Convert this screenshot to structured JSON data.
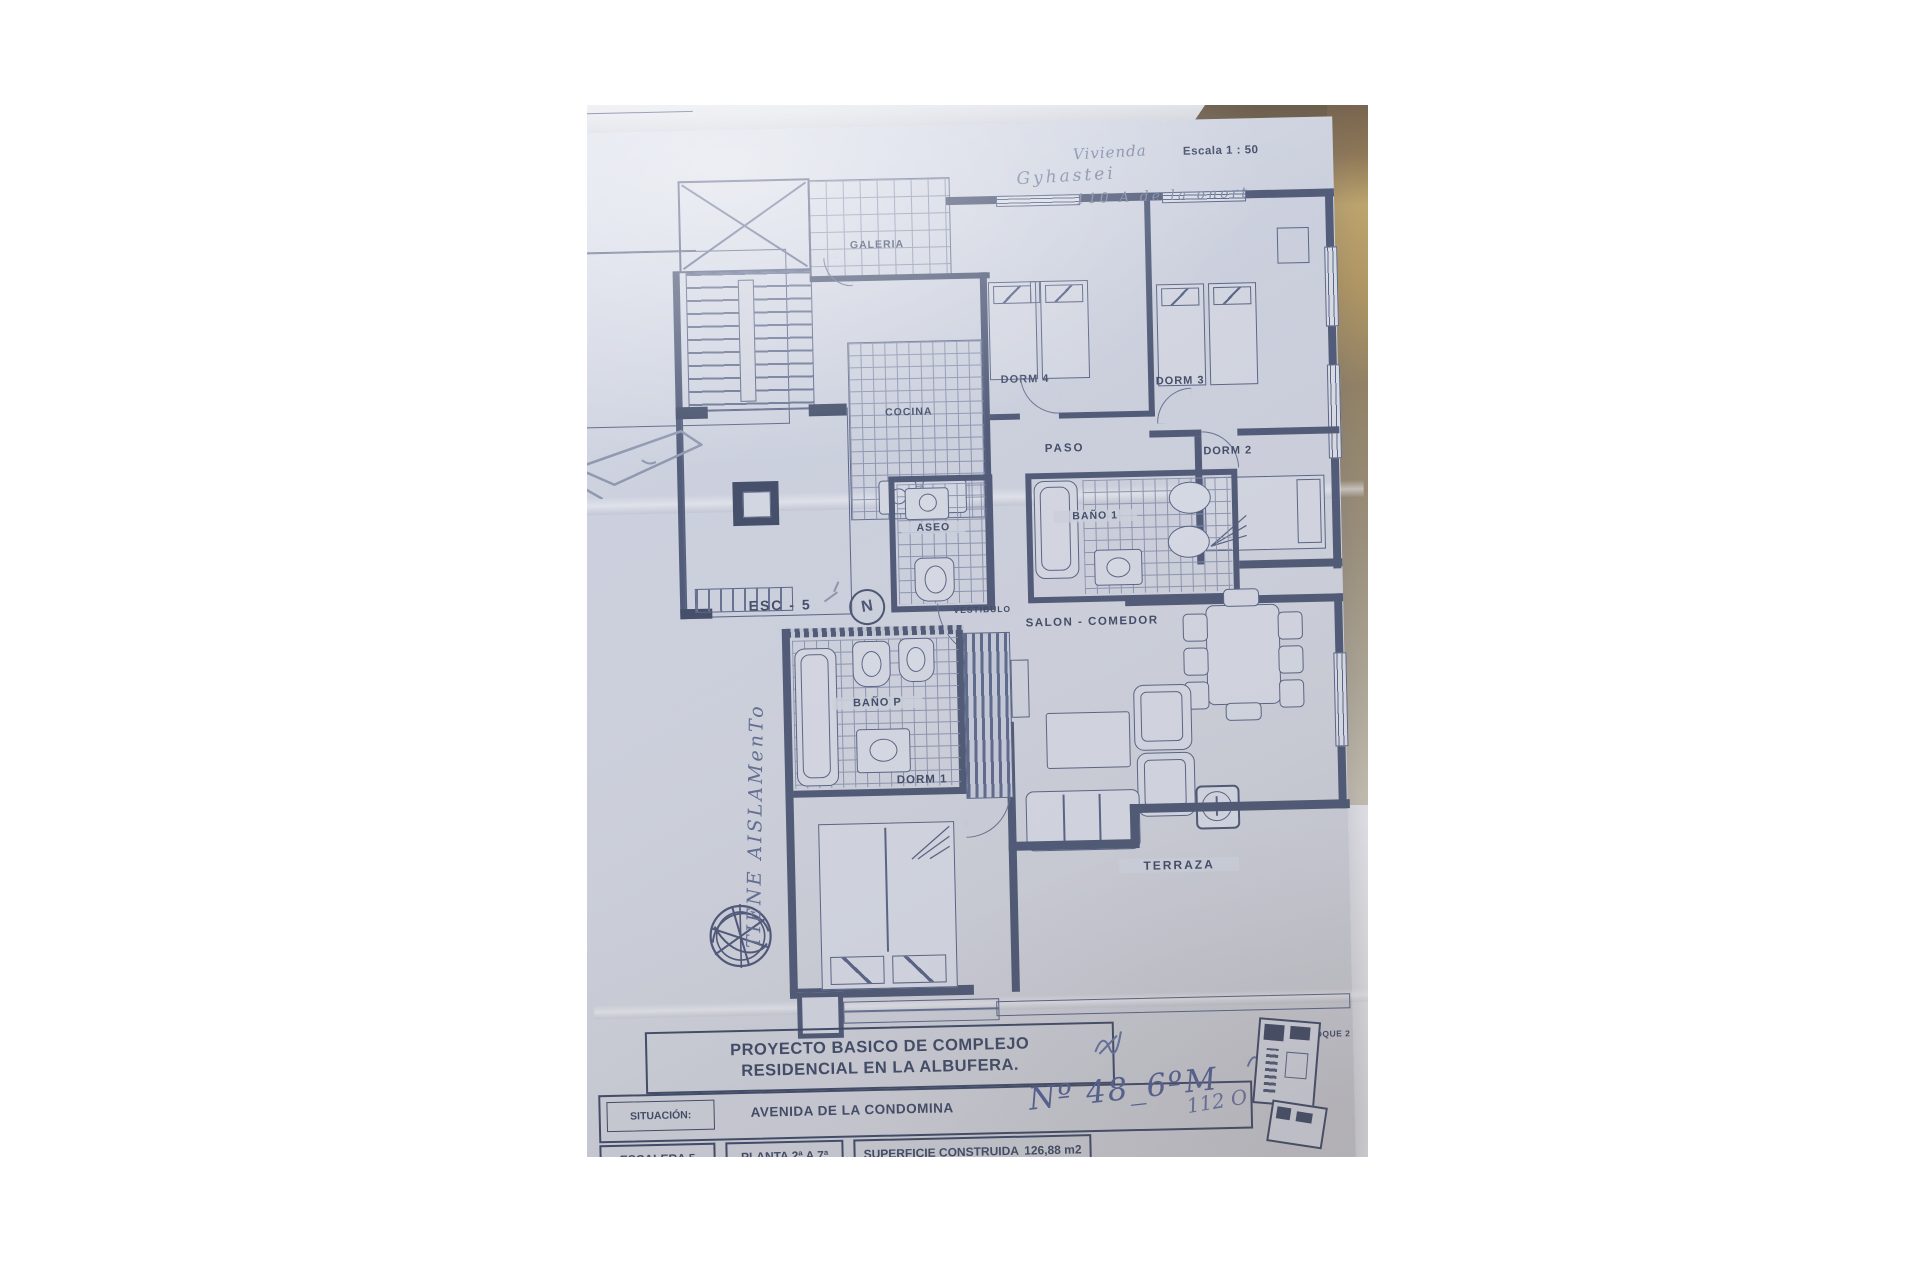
{
  "photo": {
    "scale_label": "Escala 1 : 50",
    "handwriting": {
      "line1": "Vivienda",
      "line2": "Gyhastei",
      "line3": "110 A de la onort",
      "side_note": "TIENE AISLAMenTo",
      "address_number": "Nº 48_6ºM",
      "address_extra": "112 O"
    },
    "rooms": {
      "galeria": "GALERIA",
      "cocina": "COCINA",
      "dorm4": "DORM 4",
      "dorm3": "DORM 3",
      "dorm2": "DORM 2",
      "paso": "PASO",
      "aseo": "ASEO",
      "bano1": "BAÑO 1",
      "esc": "ESC - 5",
      "north": "N",
      "vestibulo": "VESTIBULO",
      "salon": "SALON - COMEDOR",
      "banop": "BAÑO P",
      "dorm1": "DORM 1",
      "terraza": "TERRAZA"
    },
    "title_block": {
      "title_line1": "PROYECTO BASICO DE COMPLEJO",
      "title_line2": "RESIDENCIAL EN LA ALBUFERA.",
      "situacion_label": "SITUACIÓN:",
      "situacion_value": "AVENIDA DE LA CONDOMINA",
      "escalera": "ESCALERA  5",
      "planta": "PLANTA  2ª A 7ª",
      "superficie_label": "SUPERFICIE CONSTRUIDA",
      "superficie_value": "126,88 m2",
      "bloque": "BLOQUE 2"
    },
    "colors": {
      "paper": "#d4d8e4",
      "ink": "#2e3956",
      "wall": "#3f4a68",
      "pencil": "#7580a0",
      "gold": "#bd9b52",
      "wood": "#6d5434"
    }
  }
}
